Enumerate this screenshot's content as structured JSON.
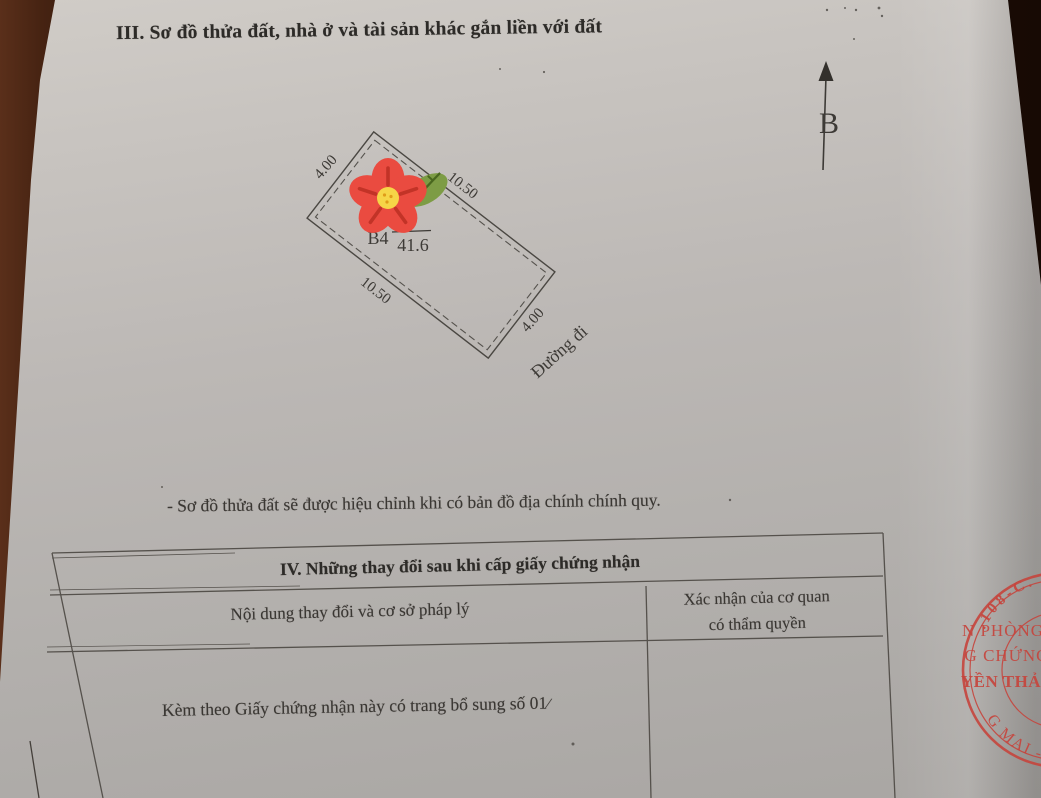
{
  "page": {
    "section_iii": {
      "title": "III. Sơ đồ thửa đất, nhà ở và tài sản khác gắn liền với đất"
    },
    "compass": {
      "north_label": "B"
    },
    "plot_diagram": {
      "block_label": "B4",
      "plot_number": "1",
      "area_value": "41.6",
      "dim_top_left": "4.00",
      "dim_top_right": "10.50",
      "dim_bottom_left": "10.50",
      "dim_bottom_right": "4.00",
      "road_label": "Đường đi"
    },
    "note": "- Sơ đồ thửa đất sẽ được hiệu chỉnh khi có bản đồ địa chính chính quy.",
    "section_iv": {
      "title": "IV. Những thay đổi sau khi cấp giấy chứng nhận",
      "col1_header": "Nội dung thay đổi và cơ sở pháp lý",
      "col2_header_line1": "Xác nhận của cơ quan",
      "col2_header_line2": "có thẩm quyền",
      "body_row": "Kèm theo Giấy chứng nhận này có trang bổ sung số 01",
      "stray_mark": "⁄"
    },
    "stamp": {
      "arc_top": ".108-C.",
      "line1": "N PHÒNG",
      "line2": "G CHỨNG",
      "line3": "YỀN THẢ",
      "arc_bottom": "G MAI - T.P"
    }
  },
  "colors": {
    "stamp_red": "#c6453d",
    "ink": "#3a3733",
    "paper": "#bcb8b5",
    "background_brown": "#33180c",
    "flower_red": "#ea4b40",
    "flower_detail_red": "#c23327",
    "flower_center_yellow": "#f6d547",
    "leaf_green": "#7d9c45",
    "leaf_vein_green": "#49671f"
  }
}
